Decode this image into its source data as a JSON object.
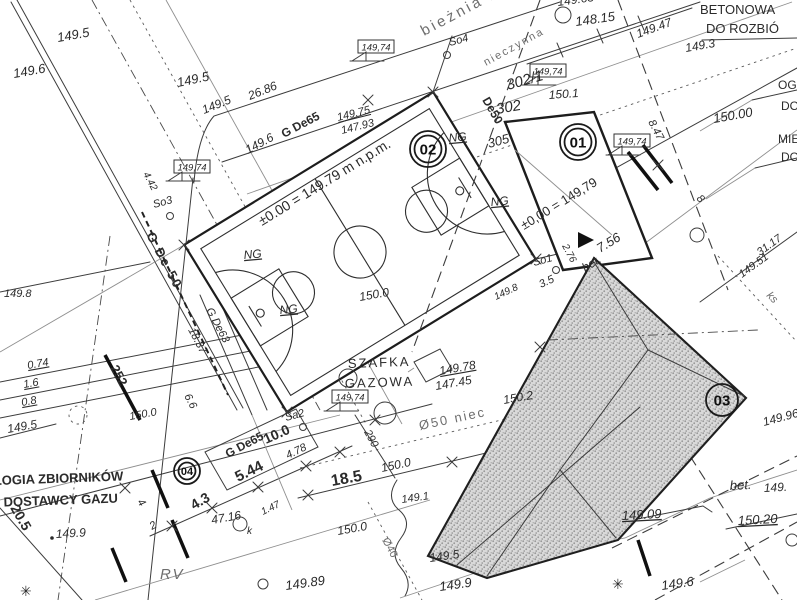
{
  "palette": {
    "paper": "#ffffff",
    "ink": "#2b2b2b",
    "light_ink": "#8a8a8a",
    "hatch_fill": "#d9d9d9",
    "hatch_dot": "#979797"
  },
  "benchmarks": [
    {
      "text": "149,74",
      "x": 358,
      "y": 40
    },
    {
      "text": "149,74",
      "x": 174,
      "y": 160
    },
    {
      "text": "149,74",
      "x": 530,
      "y": 64
    },
    {
      "text": "149,74",
      "x": 614,
      "y": 134
    },
    {
      "text": "149,74",
      "x": 332,
      "y": 390
    }
  ],
  "markers": [
    {
      "num": "02",
      "x": 428,
      "y": 149,
      "r": 18,
      "double": true
    },
    {
      "num": "01",
      "x": 578,
      "y": 142,
      "r": 18,
      "double": true
    },
    {
      "num": "03",
      "x": 722,
      "y": 400,
      "r": 16,
      "double": false
    },
    {
      "num": "04",
      "x": 187,
      "y": 471,
      "r": 13,
      "double": true
    }
  ],
  "labels": [
    {
      "t": "149.5",
      "x": 58,
      "y": 42,
      "r": -10,
      "s": 13,
      "f": "i",
      "n": "elevation-label"
    },
    {
      "t": "149.6",
      "x": 14,
      "y": 78,
      "r": -10,
      "s": 13,
      "f": "i",
      "n": "elevation-label"
    },
    {
      "t": "149.5",
      "x": 178,
      "y": 87,
      "r": -12,
      "s": 13,
      "f": "i",
      "n": "elevation-label"
    },
    {
      "t": "149.5",
      "x": 204,
      "y": 114,
      "r": -22,
      "s": 12,
      "f": "i",
      "n": "elevation-label"
    },
    {
      "t": "26.86",
      "x": 250,
      "y": 100,
      "r": -22,
      "s": 12,
      "f": "i",
      "n": "dimension-label"
    },
    {
      "t": "bieżnia żu",
      "x": 424,
      "y": 36,
      "r": -28,
      "s": 15,
      "f": "g",
      "ls": 3,
      "n": "track-label"
    },
    {
      "t": "So4",
      "x": 450,
      "y": 46,
      "r": -15,
      "s": 11,
      "f": "i",
      "n": "point-label"
    },
    {
      "t": "nieczynna",
      "x": 486,
      "y": 66,
      "r": -29,
      "s": 11,
      "f": "g",
      "ls": 2,
      "n": "utility-label"
    },
    {
      "t": "De50",
      "x": 482,
      "y": 100,
      "r": 60,
      "s": 12,
      "f": "b",
      "n": "utility-label"
    },
    {
      "t": "302/1",
      "x": 508,
      "y": 90,
      "r": -16,
      "s": 15,
      "f": "i",
      "n": "parcel-number"
    },
    {
      "t": "302",
      "x": 497,
      "y": 114,
      "r": -10,
      "s": 15,
      "f": "i",
      "n": "parcel-number"
    },
    {
      "t": "305",
      "x": 489,
      "y": 148,
      "r": -15,
      "s": 13,
      "f": "i",
      "n": "parcel-number"
    },
    {
      "t": "150.1",
      "x": 549,
      "y": 99,
      "r": -4,
      "s": 12,
      "f": "i",
      "n": "elevation-label"
    },
    {
      "t": "149.65",
      "x": 558,
      "y": 6,
      "r": -8,
      "s": 12,
      "f": "i",
      "n": "elevation-label"
    },
    {
      "t": "148.15",
      "x": 576,
      "y": 26,
      "r": -8,
      "s": 13,
      "f": "i",
      "n": "elevation-label"
    },
    {
      "t": "149.47",
      "x": 638,
      "y": 38,
      "r": -20,
      "s": 12,
      "f": "i",
      "n": "elevation-label"
    },
    {
      "t": "149.3",
      "x": 686,
      "y": 52,
      "r": -10,
      "s": 12,
      "f": "i",
      "n": "elevation-label"
    },
    {
      "t": "BETONOWA",
      "x": 700,
      "y": 14,
      "r": 0,
      "s": 13,
      "f": "",
      "n": "note-demolition"
    },
    {
      "t": "DO ROZBIÓ",
      "x": 706,
      "y": 33,
      "r": 0,
      "s": 13,
      "f": "",
      "n": "note-demolition"
    },
    {
      "t": "8.47",
      "x": 648,
      "y": 122,
      "r": 62,
      "s": 11,
      "f": "i",
      "n": "dimension-label"
    },
    {
      "t": "OGR",
      "x": 778,
      "y": 89,
      "r": 0,
      "s": 12,
      "f": "",
      "n": "note-clipped"
    },
    {
      "t": "DO",
      "x": 781,
      "y": 110,
      "r": 0,
      "s": 12,
      "f": "",
      "n": "note-clipped"
    },
    {
      "t": "150.00",
      "x": 714,
      "y": 123,
      "r": -10,
      "s": 13,
      "f": "i",
      "n": "elevation-label"
    },
    {
      "t": "MIE",
      "x": 778,
      "y": 143,
      "r": 0,
      "s": 12,
      "f": "",
      "n": "note-clipped"
    },
    {
      "t": "DO",
      "x": 781,
      "y": 161,
      "r": 0,
      "s": 12,
      "f": "",
      "n": "note-clipped"
    },
    {
      "t": "31.17",
      "x": 760,
      "y": 256,
      "r": -36,
      "s": 11,
      "f": "i",
      "n": "dimension-label"
    },
    {
      "t": "149.51",
      "x": 742,
      "y": 278,
      "r": -36,
      "s": 11,
      "f": "i",
      "n": "elevation-label"
    },
    {
      "t": "ks",
      "x": 766,
      "y": 296,
      "r": 45,
      "s": 11,
      "f": "gi",
      "n": "utility-label"
    },
    {
      "t": "149.96",
      "x": 764,
      "y": 426,
      "r": -15,
      "s": 12,
      "f": "i",
      "n": "elevation-label"
    },
    {
      "t": "G De65",
      "x": 284,
      "y": 138,
      "r": -28,
      "s": 12,
      "f": "b",
      "n": "utility-label"
    },
    {
      "t": "149.75",
      "x": 338,
      "y": 121,
      "r": -14,
      "s": 11,
      "f": "iu",
      "n": "elevation-label"
    },
    {
      "t": "147.93",
      "x": 342,
      "y": 134,
      "r": -14,
      "s": 11,
      "f": "i",
      "n": "elevation-label"
    },
    {
      "t": "149.6",
      "x": 248,
      "y": 154,
      "r": -28,
      "s": 12,
      "f": "i",
      "n": "elevation-label"
    },
    {
      "t": "±0.00 = 149.79 m n.p.m.",
      "x": 262,
      "y": 226,
      "r": -31.5,
      "s": 14,
      "f": "",
      "n": "datum-label"
    },
    {
      "t": "4.42",
      "x": 143,
      "y": 174,
      "r": 62,
      "s": 10,
      "f": "i",
      "n": "dimension-label"
    },
    {
      "t": "So3",
      "x": 154,
      "y": 208,
      "r": -15,
      "s": 11,
      "f": "i",
      "n": "point-label"
    },
    {
      "t": "G De 50",
      "x": 146,
      "y": 235,
      "r": 62,
      "s": 13,
      "f": "b",
      "ls": 2,
      "n": "utility-label"
    },
    {
      "t": "NG",
      "x": 244,
      "y": 259,
      "r": -5,
      "s": 12,
      "f": "iu",
      "n": "ground-label"
    },
    {
      "t": "NG",
      "x": 280,
      "y": 314,
      "r": -5,
      "s": 12,
      "f": "iu",
      "n": "ground-label"
    },
    {
      "t": "NG",
      "x": 449,
      "y": 142,
      "r": -5,
      "s": 12,
      "f": "iu",
      "n": "ground-label"
    },
    {
      "t": "NG",
      "x": 491,
      "y": 206,
      "r": -5,
      "s": 12,
      "f": "iu",
      "n": "ground-label"
    },
    {
      "t": "G De63",
      "x": 206,
      "y": 310,
      "r": 62,
      "s": 11,
      "f": "i",
      "n": "utility-label"
    },
    {
      "t": "18.37",
      "x": 188,
      "y": 330,
      "r": 62,
      "s": 11,
      "f": "i",
      "n": "dimension-label"
    },
    {
      "t": "150.0",
      "x": 360,
      "y": 301,
      "r": -10,
      "s": 12,
      "f": "i",
      "n": "elevation-label"
    },
    {
      "t": "6.6",
      "x": 184,
      "y": 396,
      "r": 62,
      "s": 11,
      "f": "i",
      "n": "dimension-label"
    },
    {
      "t": "±0,00 = 149,79",
      "x": 524,
      "y": 230,
      "r": -31.5,
      "s": 13,
      "f": "",
      "n": "datum-label"
    },
    {
      "t": "7.56",
      "x": 600,
      "y": 253,
      "r": -31.5,
      "s": 13,
      "f": "i",
      "n": "dimension-label"
    },
    {
      "t": "So1",
      "x": 534,
      "y": 266,
      "r": -15,
      "s": 11,
      "f": "i",
      "n": "point-label"
    },
    {
      "t": "2.76",
      "x": 562,
      "y": 246,
      "r": 62,
      "s": 10,
      "f": "i",
      "n": "dimension-label"
    },
    {
      "t": "3.5",
      "x": 541,
      "y": 288,
      "r": -25,
      "s": 11,
      "f": "i",
      "n": "dimension-label"
    },
    {
      "t": "149.8",
      "x": 496,
      "y": 300,
      "r": -25,
      "s": 10,
      "f": "i",
      "n": "elevation-label"
    },
    {
      "t": "bet.",
      "x": 585,
      "y": 272,
      "r": -31.5,
      "s": 12,
      "f": "i",
      "n": "surface-label"
    },
    {
      "t": "8",
      "x": 696,
      "y": 199,
      "r": 45,
      "s": 11,
      "f": "i",
      "n": "dimension-label"
    },
    {
      "t": "SZAFKA",
      "x": 348,
      "y": 368,
      "r": -2,
      "s": 13,
      "f": "",
      "ls": 2,
      "n": "gas-cabinet-label"
    },
    {
      "t": "GAZOWA",
      "x": 345,
      "y": 388,
      "r": -2,
      "s": 13,
      "f": "",
      "ls": 2,
      "n": "gas-cabinet-label"
    },
    {
      "t": "149.78",
      "x": 440,
      "y": 375,
      "r": -10,
      "s": 12,
      "f": "iu",
      "n": "elevation-label"
    },
    {
      "t": "147.45",
      "x": 436,
      "y": 390,
      "r": -10,
      "s": 12,
      "f": "i",
      "n": "elevation-label"
    },
    {
      "t": "150.2",
      "x": 504,
      "y": 404,
      "r": -10,
      "s": 12,
      "f": "i",
      "n": "elevation-label"
    },
    {
      "t": "Ø50 niec",
      "x": 420,
      "y": 430,
      "r": -12,
      "s": 13,
      "f": "g",
      "ls": 2,
      "n": "utility-label"
    },
    {
      "t": "290",
      "x": 364,
      "y": 432,
      "r": 62,
      "s": 11,
      "f": "i",
      "n": "utility-label"
    },
    {
      "t": "Ø40",
      "x": 382,
      "y": 540,
      "r": 62,
      "s": 11,
      "f": "g",
      "n": "utility-label"
    },
    {
      "t": "0.74",
      "x": 28,
      "y": 369,
      "r": -10,
      "s": 11,
      "f": "iu",
      "n": "dimension-label"
    },
    {
      "t": "1.6",
      "x": 24,
      "y": 388,
      "r": -10,
      "s": 11,
      "f": "iu",
      "n": "dimension-label"
    },
    {
      "t": "0.8",
      "x": 22,
      "y": 406,
      "r": -10,
      "s": 11,
      "f": "iu",
      "n": "dimension-label"
    },
    {
      "t": "252",
      "x": 110,
      "y": 368,
      "r": 62,
      "s": 13,
      "f": "b",
      "n": "utility-label"
    },
    {
      "t": "150.0",
      "x": 130,
      "y": 420,
      "r": -10,
      "s": 11,
      "f": "i",
      "n": "elevation-label"
    },
    {
      "t": "149.8",
      "x": 4,
      "y": 297,
      "r": 0,
      "s": 11,
      "f": "i",
      "n": "elevation-label"
    },
    {
      "t": "149.5",
      "x": 8,
      "y": 433,
      "r": -10,
      "s": 12,
      "f": "i",
      "n": "elevation-label"
    },
    {
      "t": "ŁOGIA ZBIORNIKÓW",
      "x": -6,
      "y": 485,
      "r": -2,
      "s": 13,
      "f": "b",
      "n": "note-gas-tanks"
    },
    {
      "t": "G DOSTAWCY GAZU",
      "x": -10,
      "y": 507,
      "r": -2,
      "s": 13,
      "f": "b",
      "n": "note-gas-tanks"
    },
    {
      "t": "20.5",
      "x": 10,
      "y": 508,
      "r": 60,
      "s": 14,
      "f": "b",
      "n": "dimension-label"
    },
    {
      "t": "149.9",
      "x": 56,
      "y": 538,
      "r": -3,
      "s": 12,
      "f": "i",
      "n": "elevation-label"
    },
    {
      "t": "4",
      "x": 137,
      "y": 502,
      "r": 55,
      "s": 11,
      "f": "i",
      "n": "dimension-label"
    },
    {
      "t": "2",
      "x": 152,
      "y": 530,
      "r": -30,
      "s": 11,
      "f": "i",
      "n": "dimension-label"
    },
    {
      "t": "4.3",
      "x": 194,
      "y": 510,
      "r": -30,
      "s": 14,
      "f": "b",
      "n": "dimension-label"
    },
    {
      "t": "47.16",
      "x": 212,
      "y": 524,
      "r": -10,
      "s": 12,
      "f": "i",
      "n": "dimension-label"
    },
    {
      "t": "G De65",
      "x": 228,
      "y": 458,
      "r": -28,
      "s": 12,
      "f": "b",
      "n": "utility-label"
    },
    {
      "t": "Sa2",
      "x": 286,
      "y": 421,
      "r": -15,
      "s": 11,
      "f": "i",
      "n": "point-label"
    },
    {
      "t": "10.0",
      "x": 266,
      "y": 444,
      "r": -24,
      "s": 14,
      "f": "b",
      "n": "dimension-label"
    },
    {
      "t": "5.44",
      "x": 238,
      "y": 482,
      "r": -26,
      "s": 15,
      "f": "b",
      "n": "dimension-label"
    },
    {
      "t": "4.78",
      "x": 288,
      "y": 459,
      "r": -26,
      "s": 11,
      "f": "i",
      "n": "dimension-label"
    },
    {
      "t": "18.5",
      "x": 332,
      "y": 486,
      "r": -10,
      "s": 16,
      "f": "b",
      "n": "dimension-label"
    },
    {
      "t": "150.0",
      "x": 382,
      "y": 472,
      "r": -12,
      "s": 12,
      "f": "i",
      "n": "elevation-label"
    },
    {
      "t": "1.47",
      "x": 263,
      "y": 515,
      "r": -26,
      "s": 10,
      "f": "i",
      "n": "dimension-label"
    },
    {
      "t": "k",
      "x": 247,
      "y": 534,
      "r": 0,
      "s": 10,
      "f": "i",
      "n": "point-label"
    },
    {
      "t": "150.0",
      "x": 338,
      "y": 535,
      "r": -10,
      "s": 12,
      "f": "i",
      "n": "elevation-label"
    },
    {
      "t": "149.89",
      "x": 286,
      "y": 590,
      "r": -8,
      "s": 13,
      "f": "i",
      "n": "elevation-label"
    },
    {
      "t": "149.1",
      "x": 402,
      "y": 503,
      "r": -8,
      "s": 11,
      "f": "i",
      "n": "elevation-label"
    },
    {
      "t": "149.5",
      "x": 430,
      "y": 562,
      "r": -8,
      "s": 12,
      "f": "i",
      "n": "elevation-label"
    },
    {
      "t": "149.9",
      "x": 440,
      "y": 591,
      "r": -8,
      "s": 13,
      "f": "i",
      "n": "elevation-label"
    },
    {
      "t": "RV",
      "x": 160,
      "y": 579,
      "r": 0,
      "s": 15,
      "f": "gi",
      "ls": 2,
      "n": "area-label"
    },
    {
      "t": "149.09",
      "x": 622,
      "y": 520,
      "r": -3,
      "s": 13,
      "f": "iu",
      "n": "elevation-label"
    },
    {
      "t": "bet.",
      "x": 730,
      "y": 490,
      "r": -3,
      "s": 13,
      "f": "i",
      "n": "surface-label"
    },
    {
      "t": "149.",
      "x": 764,
      "y": 492,
      "r": -3,
      "s": 12,
      "f": "i",
      "n": "elevation-label"
    },
    {
      "t": "150.20",
      "x": 738,
      "y": 525,
      "r": -3,
      "s": 13,
      "f": "iu",
      "n": "elevation-label"
    },
    {
      "t": "149.6",
      "x": 662,
      "y": 590,
      "r": -8,
      "s": 13,
      "f": "i",
      "n": "elevation-label"
    },
    {
      "t": "✳",
      "x": 20,
      "y": 596,
      "r": 0,
      "s": 14,
      "f": "",
      "n": "tree-symbol"
    },
    {
      "t": "✳",
      "x": 612,
      "y": 589,
      "r": 0,
      "s": 14,
      "f": "",
      "n": "tree-symbol"
    }
  ]
}
